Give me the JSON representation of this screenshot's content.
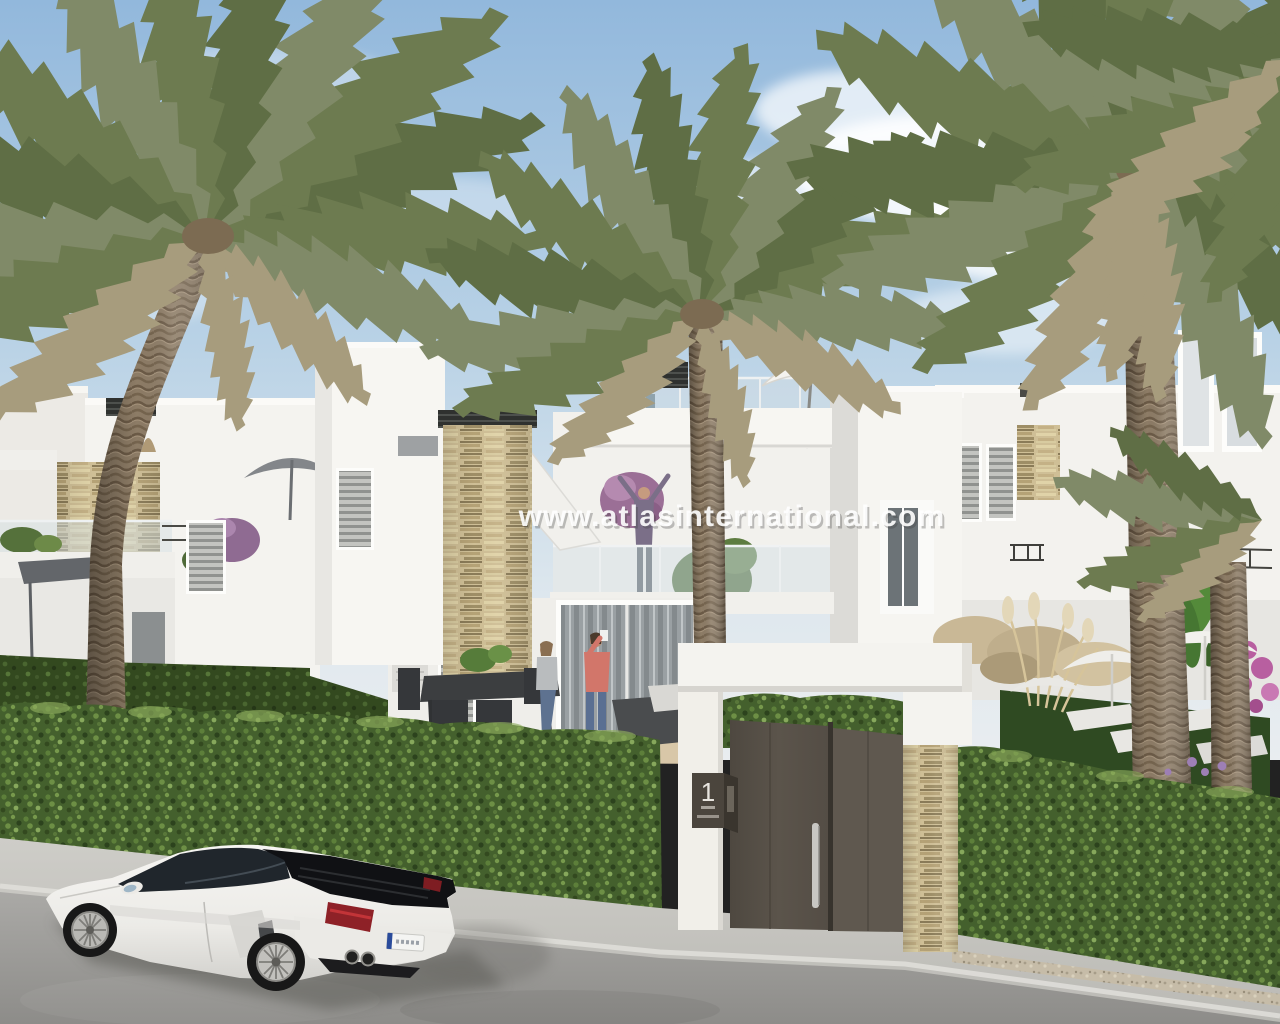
{
  "image_type": "real-estate-architectural-render",
  "watermark": {
    "text": "www.atlasinternational.com"
  },
  "gate": {
    "plaque_number": "1"
  },
  "palette": {
    "sky_top": "#92b8dc",
    "sky_horizon": "#e9edf0",
    "building_white": "#f4f3ef",
    "building_shade": "#dfdedb",
    "stone_cladding": "#cfbf96",
    "hedge_green": "#44602d",
    "palm_green": "#6d7b50",
    "palm_dry": "#a79c7d",
    "door_bronze": "#585148",
    "door_bronze_light": "#5f584f",
    "road_gray": "#a3a2a0",
    "sidewalk_gray": "#c6c5c0",
    "car_white": "#f0efec",
    "taillight_red": "#8e2127",
    "parasol_white": "#f2f1ed",
    "parasol_gray": "#83868a",
    "bougainvillea_pink": "#b85fa0"
  },
  "scene_elements": [
    "sky",
    "clouds",
    "palm-tree-left",
    "palm-tree-center",
    "palm-tree-right",
    "white-villas",
    "roof-terrace",
    "stone-clad-columns",
    "glass-balustrades",
    "people-on-terraces",
    "dining-set",
    "sun-loungers",
    "parasols",
    "garden-hedges",
    "entrance-gate",
    "address-plaque",
    "street",
    "sidewalk",
    "white-sports-car",
    "watermark"
  ]
}
